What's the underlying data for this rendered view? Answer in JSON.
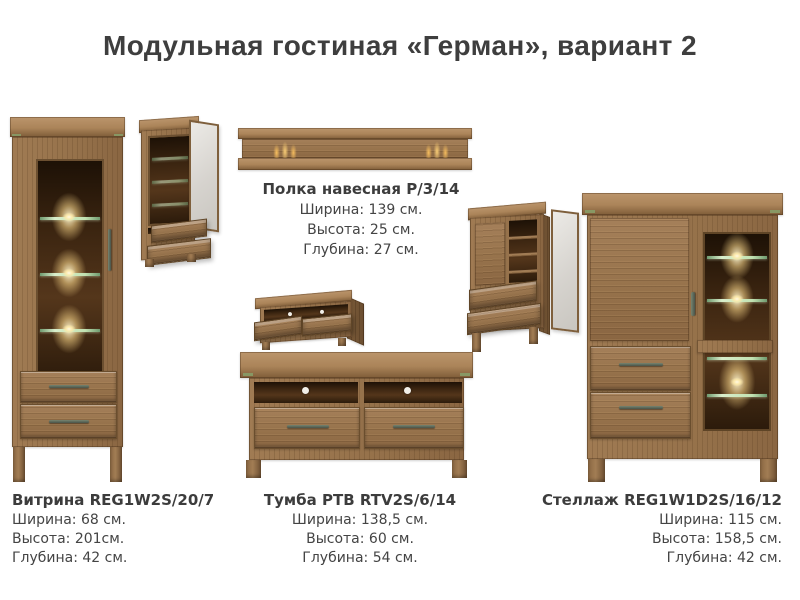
{
  "title": "Модульная гостиная «Герман», вариант 2",
  "specs": {
    "shelf": {
      "name": "Полка навесная Р/3/14",
      "width": "Ширина: 139 см.",
      "height": "Высота: 25 см.",
      "depth": "Глубина: 27 см."
    },
    "vitrine": {
      "name": "Витрина REG1W2S/20/7",
      "width": "Ширина: 68 см.",
      "height": "Высота: 201см.",
      "depth": "Глубина: 42 см."
    },
    "tv": {
      "name": "Тумба РТВ RTV2S/6/14",
      "width": "Ширина: 138,5 см.",
      "height": "Высота: 60 см.",
      "depth": "Глубина: 54 см."
    },
    "shelving": {
      "name": "Стеллаж REG1W1D2S/16/12",
      "width": "Ширина: 115 см.",
      "height": "Высота: 158,5 см.",
      "depth": "Глубина: 42 см."
    }
  },
  "colors": {
    "wood": "#9c7850",
    "wood_dark": "#6b4f30",
    "interior": "#35220f",
    "glass_shelf_green": "#9dc293",
    "light_glow": "#ffe3a0",
    "accent_green": "#87a06a",
    "title_text": "#3e3e3e",
    "background": "#ffffff"
  }
}
